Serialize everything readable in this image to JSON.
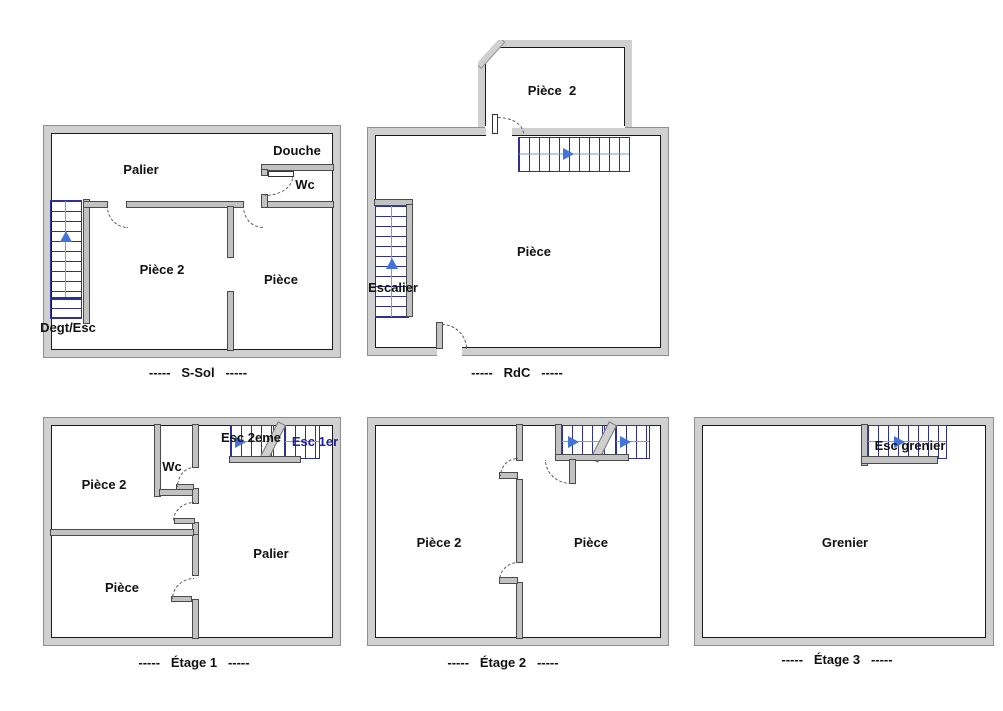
{
  "colors": {
    "outer_wall_fill": "#d0d0d0",
    "outer_wall_edge": "#8f8f8f",
    "wall_inner_line": "#1a1a1a",
    "interior_wall_fill": "#c2c2c2",
    "stair_tread": "#2e3192",
    "stair_center_line": "#7b9bd6",
    "stair_arrow": "#4273d8",
    "door_arc": "#555555",
    "label_text": "#111111",
    "esc_1er_text": "#20209a"
  },
  "plans": {
    "ssol": {
      "caption": "-----   S-Sol   -----",
      "labels": {
        "palier": "Palier",
        "douche": "Douche",
        "wc": "Wc",
        "piece2": "Pièce 2",
        "piece": "Pièce",
        "degt_esc": "Degt/Esc"
      }
    },
    "rdc": {
      "caption": "-----   RdC   -----",
      "labels": {
        "piece2": "Pièce  2",
        "piece": "Pièce",
        "escalier": "Escalier"
      }
    },
    "etage1": {
      "caption": "-----   Étage 1   -----",
      "labels": {
        "piece2": "Pièce 2",
        "wc": "Wc",
        "esc_2eme": "Esc 2eme",
        "esc_1er": "Esc 1er",
        "palier": "Palier",
        "piece": "Pièce"
      }
    },
    "etage2": {
      "caption": "-----   Étage 2   -----",
      "labels": {
        "piece2": "Pièce 2",
        "piece": "Pièce"
      }
    },
    "etage3": {
      "caption": "-----   Étage 3   -----",
      "labels": {
        "esc_grenier": "Esc grenier",
        "grenier": "Grenier"
      }
    }
  }
}
